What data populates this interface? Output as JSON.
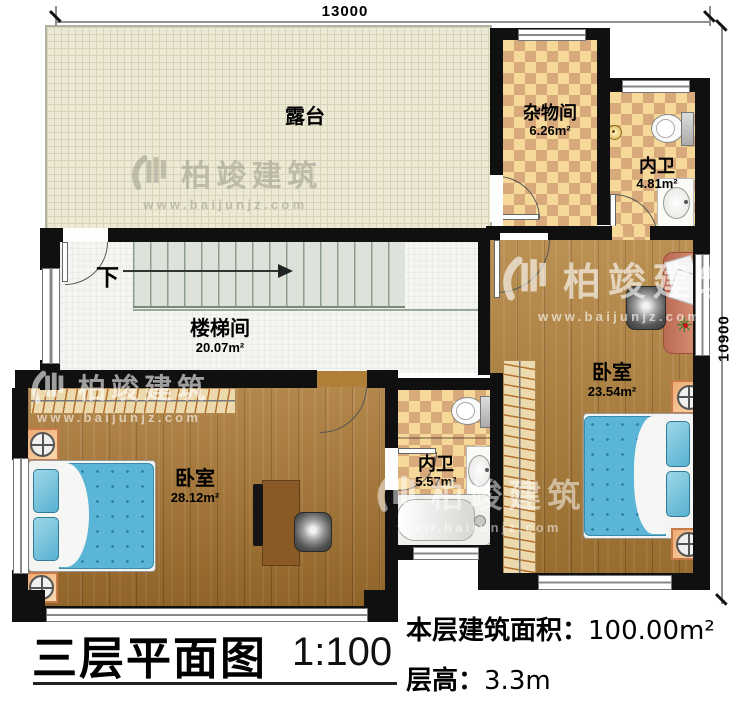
{
  "dimensions": {
    "top": "13000",
    "right": "10900"
  },
  "rooms": {
    "terrace": {
      "name": "露台"
    },
    "storage": {
      "name": "杂物间",
      "area": "6.26m²"
    },
    "bath_top": {
      "name": "内卫",
      "area": "4.81m²"
    },
    "stairwell": {
      "name": "楼梯间",
      "area": "20.07m²",
      "down": "下"
    },
    "bedroom_right": {
      "name": "卧室",
      "area": "23.54m²"
    },
    "bath_mid": {
      "name": "内卫",
      "area": "5.57m²"
    },
    "bedroom_left": {
      "name": "卧室",
      "area": "28.12m²"
    }
  },
  "titleblock": {
    "title": "三层平面图",
    "scale": "1:100",
    "area_label": "本层建筑面积：",
    "area_value": "100.00m²",
    "height_label": "层高：",
    "height_value": "3.3m"
  },
  "watermark": {
    "brand": "柏竣建筑",
    "url": "www.baijunjz.com"
  },
  "colors": {
    "wall": "#101010",
    "wood_floor": "#a8752f",
    "tile_light": "#f6d898",
    "tile_dark": "#d7a97b",
    "terrace_tile": "#ecead6",
    "bed_blue": "#5bb5d6",
    "desk_salmon": "#cd8166"
  }
}
